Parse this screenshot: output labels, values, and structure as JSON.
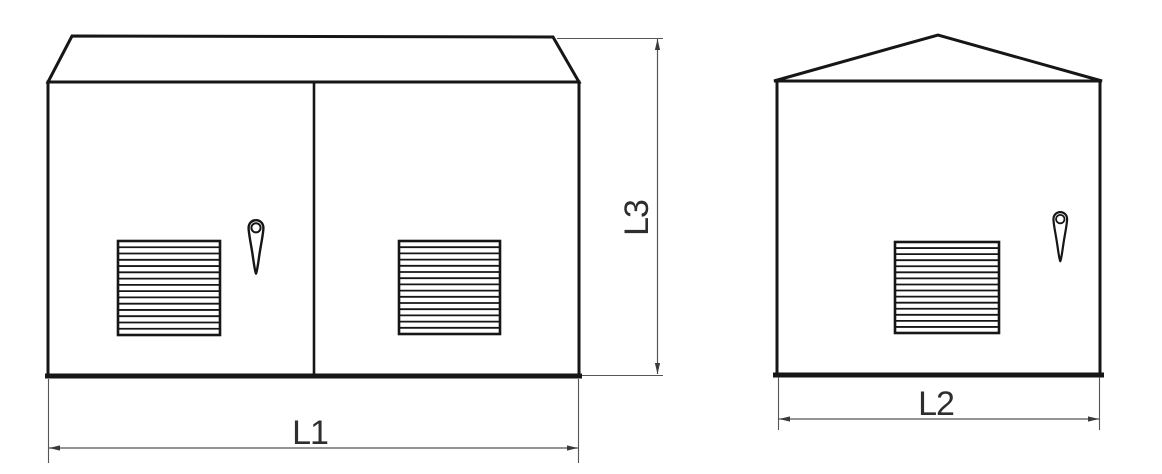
{
  "drawing": {
    "background": "#ffffff",
    "line_color": "#161616",
    "dimension_line_color": "#555555",
    "text_color": "#2e2e2e",
    "grille": {
      "louver_count": 14
    },
    "dimensions": {
      "l1": "L1",
      "l2": "L2",
      "l3": "L3"
    }
  }
}
